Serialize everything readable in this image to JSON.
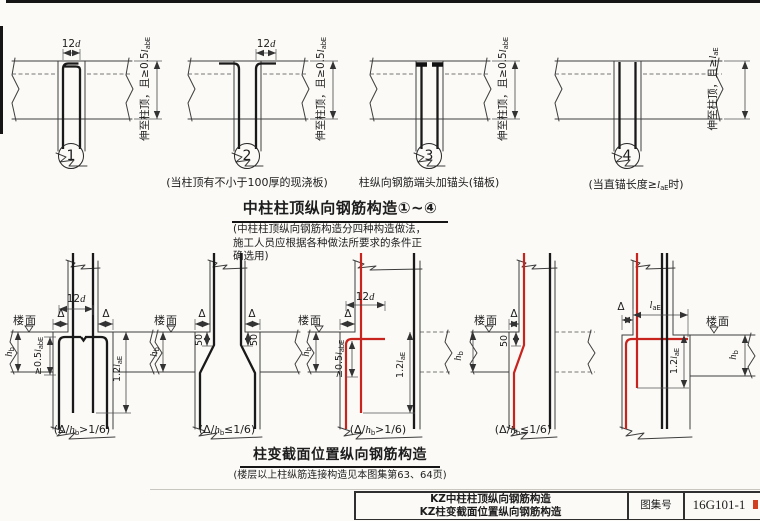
{
  "top_section": {
    "heading": "中柱柱顶纵向钢筋构造①~④",
    "note_lines": [
      "(中柱柱顶纵向钢筋构造分四种构造做法，",
      "施工人员应根据各种做法所要求的条件正",
      "确选用)"
    ],
    "labels": {
      "dim_12d": {
        "pre": "12",
        "it": "d"
      },
      "side_anchor_bend": {
        "pre": "伸至柱顶，且≥0.5",
        "it": "l",
        "sub": "abE"
      },
      "side_anchor_straight": {
        "pre": "伸至柱顶，且≥",
        "it": "l",
        "sub": "aE"
      }
    },
    "diagrams": [
      {
        "num": "1",
        "caption": {
          "pre": ""
        }
      },
      {
        "num": "2",
        "caption": {
          "pre": "(当柱顶有不小于100厚的现浇板)"
        }
      },
      {
        "num": "3",
        "caption": {
          "pre": "柱纵向钢筋端头加锚头(锚板)"
        }
      },
      {
        "num": "4",
        "caption": {
          "pre": "(当直锚长度≥",
          "it": "l",
          "sub": "aE",
          "post": "时)"
        }
      }
    ]
  },
  "bottom_section": {
    "heading": "柱变截面位置纵向钢筋构造",
    "note": "(楼层以上柱纵筋连接构造见本图集第63、64页)",
    "labels": {
      "floor": "楼面",
      "delta": "Δ",
      "fifty": "50",
      "dim_12d": {
        "pre": "12",
        "it": "d"
      },
      "hb": {
        "it": "h",
        "sub": "b"
      },
      "anchor_05lab": {
        "pre": "≥0.5",
        "it": "l",
        "sub": "abE"
      },
      "anchor_12lae": {
        "pre": "1.2",
        "it": "l",
        "sub": "aE"
      },
      "lae": {
        "it": "l",
        "sub": "aE"
      }
    },
    "captions": {
      "gt": {
        "pre": "(Δ/",
        "it": "h",
        "sub": "b",
        "post": ">1/6)"
      },
      "le": {
        "pre": "(Δ/",
        "it": "h",
        "sub": "b",
        "post": "≤1/6)"
      }
    }
  },
  "title_block": {
    "line1": "KZ中柱柱顶纵向钢筋构造",
    "line2": "KZ柱变截面位置纵向钢筋构造",
    "atlas_label": "图集号",
    "atlas_no": "16G101-1"
  },
  "colors": {
    "rebar_red": "#c8231d",
    "rebar_black": "#191919",
    "line_dark": "#3d3d3d"
  }
}
